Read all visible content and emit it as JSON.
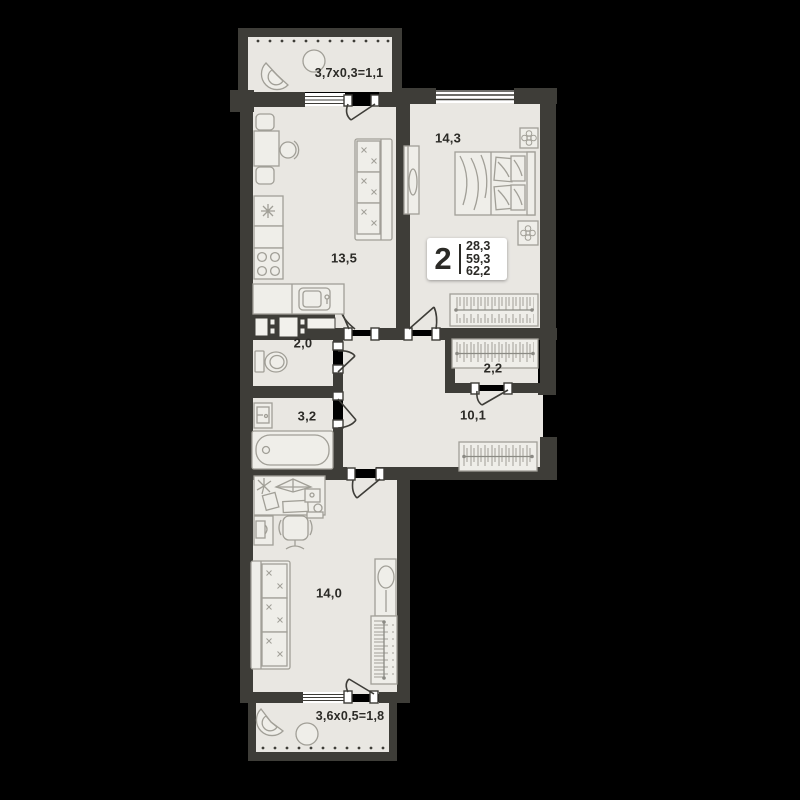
{
  "apartment_badge": {
    "rooms_count": "2",
    "areas": [
      "28,3",
      "59,3",
      "62,2"
    ]
  },
  "room_areas": {
    "kitchen_living": "13,5",
    "bedroom": "14,3",
    "wc": "2,0",
    "wardrobe_room": "2,2",
    "bathroom": "3,2",
    "hallway": "10,1",
    "room": "14,0"
  },
  "balconies": {
    "top": "3,7х0,3=1,1",
    "bottom": "3,6х0,5=1,8"
  },
  "colors": {
    "background": "#000000",
    "walls": "#3e3d38",
    "floor": "#e9e7e2",
    "furniture_lines": "#a19f97",
    "text": "#2b2a26",
    "badge_background": "#ffffff"
  },
  "furniture": {
    "kitchen_living": [
      "dining-table",
      "chairs",
      "fridge",
      "stove",
      "kitchen-sink",
      "sofa"
    ],
    "bedroom": [
      "double-bed",
      "nightstands-with-plants",
      "mirror-dresser",
      "wardrobe"
    ],
    "wc": [
      "toilet",
      "ventilation-shaft"
    ],
    "bathroom": [
      "washbasin",
      "bathtub"
    ],
    "hallway": [
      "wardrobe"
    ],
    "room": [
      "desk",
      "office-chair",
      "cabinet",
      "sofa",
      "mirror",
      "wardrobe"
    ],
    "balcony_top": [
      "armchair",
      "round-table"
    ],
    "balcony_bottom": [
      "armchair",
      "round-table"
    ]
  }
}
